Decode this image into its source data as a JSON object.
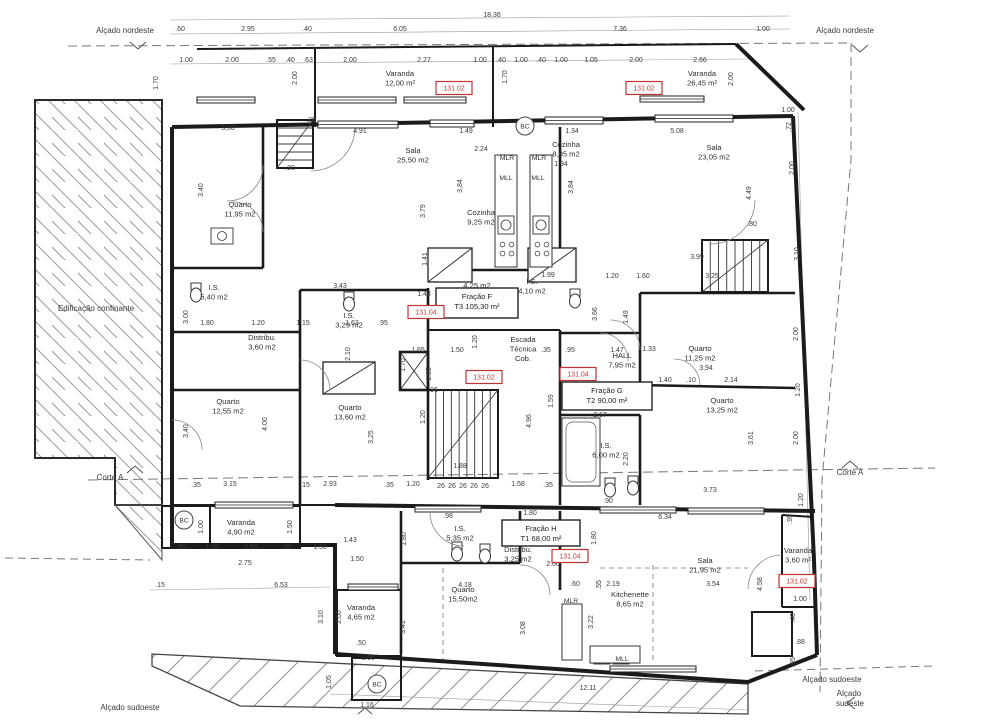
{
  "drawing": {
    "type": "architectural-floor-plan",
    "overall_width_dim": "18.36"
  },
  "colors": {
    "line": "#1b1b1b",
    "dim_text": "#3c3c3c",
    "red": "#c43333",
    "hatch": "#9b9b9b",
    "dashed": "#777777"
  },
  "annotations": [
    {
      "t": "Alçado nordeste",
      "x": 125,
      "y": 33
    },
    {
      "t": "Alçado nordeste",
      "x": 845,
      "y": 33
    },
    {
      "t": "Edificação confinante",
      "x": 96,
      "y": 311
    },
    {
      "t": "Corte A",
      "x": 110,
      "y": 480
    },
    {
      "t": "Corte A",
      "x": 850,
      "y": 475
    },
    {
      "t": "Alçado sudoeste",
      "x": 130,
      "y": 710
    },
    {
      "t": "Alçado sudoeste",
      "x": 832,
      "y": 682
    },
    {
      "t": "Alçado",
      "x": 849,
      "y": 696
    },
    {
      "t": "sudeste",
      "x": 850,
      "y": 706
    }
  ],
  "rooms": [
    {
      "lines": [
        "Varanda",
        "12,00 m²"
      ],
      "x": 400,
      "y": 76
    },
    {
      "lines": [
        "Varanda",
        "26,45 m²"
      ],
      "x": 702,
      "y": 76
    },
    {
      "lines": [
        "Quarto",
        "11,95 m2"
      ],
      "x": 240,
      "y": 207
    },
    {
      "lines": [
        "Sala",
        "25,50 m2"
      ],
      "x": 413,
      "y": 153
    },
    {
      "lines": [
        "Cozinha",
        "9,25 m2"
      ],
      "x": 481,
      "y": 215
    },
    {
      "lines": [
        "Cozinha",
        "8,05 m2"
      ],
      "x": 566,
      "y": 147
    },
    {
      "lines": [
        "Sala",
        "23,05 m2"
      ],
      "x": 714,
      "y": 150
    },
    {
      "lines": [
        "I.S.",
        "5,40 m2"
      ],
      "x": 214,
      "y": 290
    },
    {
      "lines": [
        "Distribu.",
        "3,60 m2"
      ],
      "x": 262,
      "y": 340
    },
    {
      "lines": [
        "I.S.",
        "3,29 m2"
      ],
      "x": 349,
      "y": 318
    },
    {
      "lines": [
        "4,25 m2"
      ],
      "x": 477,
      "y": 288
    },
    {
      "lines": [
        "I.S.",
        "4,10 m2"
      ],
      "x": 532,
      "y": 284
    },
    {
      "lines": [
        "Escada",
        "Técnica",
        "Cob."
      ],
      "x": 523,
      "y": 342
    },
    {
      "lines": [
        "HALL",
        "7,95 m2"
      ],
      "x": 622,
      "y": 358
    },
    {
      "lines": [
        "Quarto",
        "11,25 m2"
      ],
      "x": 700,
      "y": 351
    },
    {
      "lines": [
        "Quarto",
        "12,55 m2"
      ],
      "x": 228,
      "y": 404
    },
    {
      "lines": [
        "Quarto",
        "13,60 m2"
      ],
      "x": 350,
      "y": 410
    },
    {
      "lines": [
        "I.S.",
        "6,00 m2"
      ],
      "x": 606,
      "y": 448
    },
    {
      "lines": [
        "Quarto",
        "13,25 m2"
      ],
      "x": 722,
      "y": 403
    },
    {
      "lines": [
        "Varanda",
        "4,90 m2"
      ],
      "x": 241,
      "y": 525
    },
    {
      "lines": [
        "I.S.",
        "5,35 m2"
      ],
      "x": 460,
      "y": 531
    },
    {
      "lines": [
        "Distribu.",
        "3,25 m2"
      ],
      "x": 518,
      "y": 552
    },
    {
      "lines": [
        "Sala",
        "21,95 m2"
      ],
      "x": 705,
      "y": 563
    },
    {
      "lines": [
        "Kitchenette",
        "8,65 m2"
      ],
      "x": 630,
      "y": 597
    },
    {
      "lines": [
        "Quarto",
        "15,50m2"
      ],
      "x": 463,
      "y": 592
    },
    {
      "lines": [
        "Varanda",
        "4,65 m2"
      ],
      "x": 361,
      "y": 610
    },
    {
      "lines": [
        "Varanda",
        "3,60 m²"
      ],
      "x": 798,
      "y": 553
    }
  ],
  "fraction_boxes": [
    {
      "lines": [
        "Fração F",
        "T3 105,30 m²"
      ],
      "x": 477,
      "bx": 436,
      "by": 288,
      "bw": 82,
      "bh": 30
    },
    {
      "lines": [
        "Fração G",
        "T2 90,00 m²"
      ],
      "x": 607,
      "bx": 562,
      "by": 382,
      "bw": 90,
      "bh": 28
    },
    {
      "lines": [
        "Fração H",
        "T1 68,00 m²"
      ],
      "x": 541,
      "bx": 502,
      "by": 520,
      "bw": 78,
      "bh": 26
    }
  ],
  "red_tags": [
    {
      "t": "131.02",
      "x": 454,
      "y": 88
    },
    {
      "t": "131.02",
      "x": 644,
      "y": 88
    },
    {
      "t": "131.04",
      "x": 426,
      "y": 312
    },
    {
      "t": "131.02",
      "x": 484,
      "y": 377
    },
    {
      "t": "131.04",
      "x": 578,
      "y": 374
    },
    {
      "t": "131.04",
      "x": 570,
      "y": 556
    },
    {
      "t": "131.02",
      "x": 797,
      "y": 581
    }
  ],
  "small_labels": [
    {
      "t": "MLR",
      "x": 507,
      "y": 160
    },
    {
      "t": "MLR",
      "x": 539,
      "y": 160
    },
    {
      "t": "MLL",
      "x": 506,
      "y": 180
    },
    {
      "t": "MLL",
      "x": 538,
      "y": 180
    },
    {
      "t": "MLR",
      "x": 571,
      "y": 603
    },
    {
      "t": "MLL",
      "x": 622,
      "y": 661
    }
  ],
  "bc_markers": [
    {
      "t": "BC",
      "x": 525,
      "y": 126
    },
    {
      "t": "BC",
      "x": 184,
      "y": 520
    },
    {
      "t": "BC",
      "x": 377,
      "y": 684
    }
  ],
  "dims": [
    [
      ".60",
      180,
      31
    ],
    [
      "2.95",
      248,
      31
    ],
    [
      ".40",
      307,
      31
    ],
    [
      "6.05",
      400,
      31
    ],
    [
      "7.36",
      620,
      31
    ],
    [
      "1.00",
      763,
      31
    ],
    [
      "18.36",
      492,
      17
    ],
    [
      "1.00",
      186,
      62
    ],
    [
      "2.00",
      232,
      62
    ],
    [
      ".55",
      271,
      62
    ],
    [
      ".40",
      290,
      62
    ],
    [
      ".63",
      308,
      62
    ],
    [
      "2.00",
      350,
      62
    ],
    [
      "2.27",
      424,
      62
    ],
    [
      "1.00",
      480,
      62
    ],
    [
      ".40",
      501,
      62
    ],
    [
      "1.00",
      521,
      62
    ],
    [
      ".40",
      541,
      62
    ],
    [
      "1.00",
      561,
      62
    ],
    [
      "1.05",
      591,
      62
    ],
    [
      "2.00",
      636,
      62
    ],
    [
      "2.66",
      700,
      62
    ],
    [
      "1.70",
      158,
      83,
      1
    ],
    [
      "2.00",
      297,
      78,
      1
    ],
    [
      "1.70",
      507,
      77,
      1
    ],
    [
      "2.00",
      733,
      79,
      1
    ],
    [
      "1.00",
      788,
      112
    ],
    [
      ".72",
      791,
      127,
      1
    ],
    [
      "2.00",
      794,
      168,
      1
    ],
    [
      "3.10",
      799,
      254,
      1
    ],
    [
      "3,60",
      228,
      130
    ],
    [
      "4.91",
      360,
      133
    ],
    [
      "1.49",
      466,
      133
    ],
    [
      "1.34",
      572,
      133
    ],
    [
      "5.08",
      677,
      133
    ],
    [
      "2.24",
      481,
      151
    ],
    [
      "1.94",
      561,
      166
    ],
    [
      ".80",
      290,
      170
    ],
    [
      ".80",
      752,
      226
    ],
    [
      ".25",
      311,
      122
    ],
    [
      "3.40",
      203,
      190,
      1
    ],
    [
      "3.79",
      425,
      211,
      1
    ],
    [
      "3,84",
      462,
      186,
      1
    ],
    [
      "3,84",
      573,
      187,
      1
    ],
    [
      "4.49",
      751,
      193,
      1
    ],
    [
      "1.41",
      427,
      259,
      1
    ],
    [
      "3.43",
      340,
      288
    ],
    [
      "1.48",
      424,
      296
    ],
    [
      "1.99",
      548,
      277
    ],
    [
      "3.99",
      697,
      259
    ],
    [
      "1.20",
      612,
      278
    ],
    [
      "1.60",
      643,
      278
    ],
    [
      "3.25",
      712,
      278
    ],
    [
      "3.00",
      188,
      317,
      1
    ],
    [
      "1.80",
      207,
      325
    ],
    [
      "1.20",
      258,
      325
    ],
    [
      "1.15",
      303,
      325
    ],
    [
      "1.63",
      352,
      325
    ],
    [
      ".95",
      383,
      325
    ],
    [
      "2.10",
      350,
      354,
      1
    ],
    [
      "1.65",
      418,
      352
    ],
    [
      "1.50",
      457,
      352
    ],
    [
      ".35",
      546,
      352
    ],
    [
      ".95",
      570,
      352
    ],
    [
      "1.47",
      617,
      352
    ],
    [
      "1.33",
      649,
      351
    ],
    [
      "1.70",
      405,
      365,
      1
    ],
    [
      "1.95",
      431,
      374,
      1
    ],
    [
      ".96",
      433,
      392
    ],
    [
      "1.20",
      477,
      342,
      1
    ],
    [
      "3.66",
      597,
      314,
      1
    ],
    [
      "1.49",
      628,
      317,
      1
    ],
    [
      "1.40",
      665,
      382
    ],
    [
      ".10",
      691,
      382
    ],
    [
      "2.14",
      731,
      382
    ],
    [
      "3,94",
      706,
      370
    ],
    [
      "2.67",
      600,
      417
    ],
    [
      "4.00",
      267,
      424,
      1
    ],
    [
      "3,40",
      188,
      431,
      1
    ],
    [
      "3,25",
      373,
      437,
      1
    ],
    [
      ".35",
      196,
      487
    ],
    [
      "3.15",
      230,
      486
    ],
    [
      ".15",
      305,
      487
    ],
    [
      "2.93",
      330,
      486
    ],
    [
      ".35",
      389,
      487
    ],
    [
      "1.20",
      413,
      486
    ],
    [
      "26",
      441,
      488
    ],
    [
      "26",
      452,
      488
    ],
    [
      "26",
      463,
      488
    ],
    [
      "26",
      474,
      488
    ],
    [
      "26",
      485,
      488
    ],
    [
      "1.58",
      518,
      486
    ],
    [
      ".35",
      548,
      487
    ],
    [
      "1.88",
      460,
      468
    ],
    [
      "3.73",
      710,
      492
    ],
    [
      "1.20",
      425,
      417,
      1
    ],
    [
      "4.96",
      531,
      421,
      1
    ],
    [
      "1.59",
      553,
      401,
      1
    ],
    [
      "2.20",
      628,
      459,
      1
    ],
    [
      ".90",
      608,
      503
    ],
    [
      "3,61",
      753,
      438,
      1
    ],
    [
      "2.00",
      798,
      334,
      1
    ],
    [
      "1.20",
      800,
      390,
      1
    ],
    [
      "2.00",
      798,
      438,
      1
    ],
    [
      "1.20",
      803,
      500,
      1
    ],
    [
      ".95",
      792,
      519,
      1
    ],
    [
      ".90",
      181,
      549
    ],
    [
      "1.00",
      212,
      549
    ],
    [
      "1.50",
      251,
      549
    ],
    [
      ".35",
      286,
      549
    ],
    [
      "1.50",
      320,
      549
    ],
    [
      "1.43",
      350,
      542
    ],
    [
      "1.50",
      357,
      561
    ],
    [
      "2.75",
      245,
      565
    ],
    [
      "6.53",
      281,
      587
    ],
    [
      ".15",
      160,
      587
    ],
    [
      "1.00",
      203,
      527,
      1
    ],
    [
      "1.50",
      292,
      527,
      1
    ],
    [
      ".98",
      448,
      518
    ],
    [
      "1.80",
      530,
      515
    ],
    [
      "1.80",
      406,
      539,
      1
    ],
    [
      "1.80",
      596,
      538,
      1
    ],
    [
      "4.18",
      465,
      587
    ],
    [
      ".60",
      575,
      586
    ],
    [
      ".55",
      601,
      585,
      1
    ],
    [
      "2.60",
      553,
      566
    ],
    [
      "6.34",
      665,
      519
    ],
    [
      "2.19",
      613,
      586
    ],
    [
      "3.54",
      713,
      586
    ],
    [
      "3,22",
      593,
      622,
      1
    ],
    [
      "3.08",
      525,
      628,
      1
    ],
    [
      "3.41",
      405,
      627,
      1
    ],
    [
      "3.10",
      323,
      617,
      1
    ],
    [
      "2.00",
      341,
      617,
      1
    ],
    [
      ".50",
      361,
      645
    ],
    [
      "1.00",
      368,
      660
    ],
    [
      "1.05",
      331,
      682,
      1
    ],
    [
      "1.16",
      367,
      707
    ],
    [
      "12.11",
      588,
      690
    ],
    [
      ".88",
      800,
      644
    ],
    [
      ".95",
      795,
      662,
      1
    ],
    [
      "1.00",
      800,
      601
    ],
    [
      ".40",
      795,
      618,
      1
    ],
    [
      "4.58",
      762,
      584,
      1
    ]
  ]
}
